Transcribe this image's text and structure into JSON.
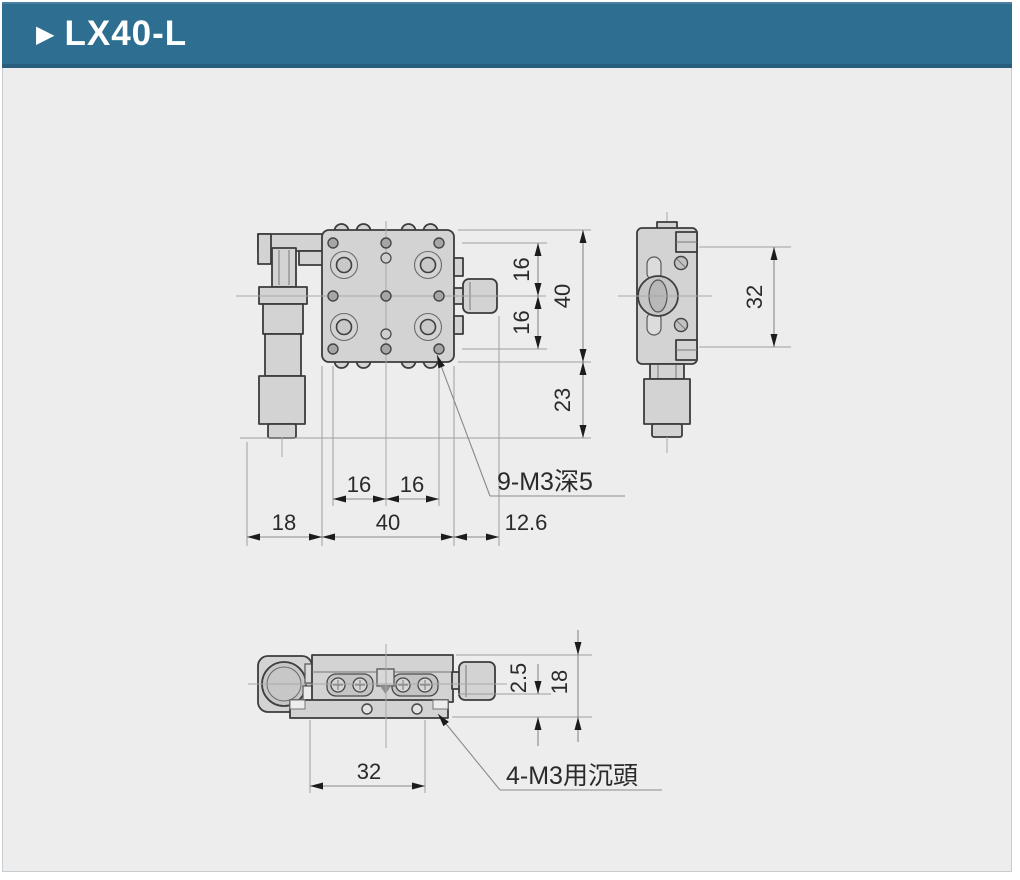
{
  "header": {
    "bullet": "▶",
    "title": "LX40-L"
  },
  "views": {
    "front": {
      "dims": {
        "row_pitch_upper": "16",
        "row_pitch_lower": "16",
        "plate_height": "40",
        "base_drop": "23",
        "col_pitch_left": "16",
        "col_pitch_right": "16",
        "micrometer_side": "18",
        "plate_width": "40",
        "knob_side": "12.6"
      },
      "annotation": "9-M3深5"
    },
    "side": {
      "dims": {
        "hole_span": "32"
      }
    },
    "bottom": {
      "dims": {
        "plate_offset": "2.5",
        "stage_height": "18",
        "hole_span": "32"
      },
      "annotation": "4-M3用沉頭"
    }
  },
  "colors": {
    "header_bg": "#2e6f91",
    "body_bg": "#ededed",
    "outline": "#3c3c3c",
    "fill_gray": "#d3d3d3",
    "dim_line": "#8a8a8a"
  }
}
